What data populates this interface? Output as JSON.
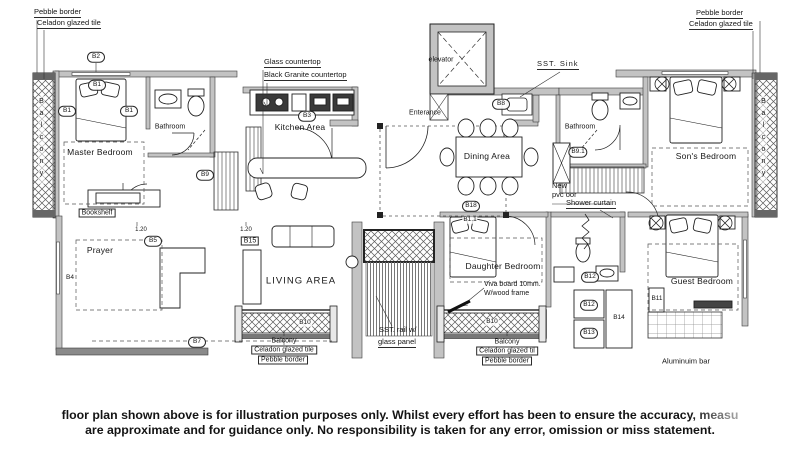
{
  "colors": {
    "ink": "#1b1b1b",
    "wall_fill": "#c3c3c3",
    "dark_wall": "#8a8a8a"
  },
  "rooms": {
    "master_bedroom": "Master Bedroom",
    "bathroom_left": "Bathroom",
    "kitchen": "Kitchen Area",
    "living": "LIVING AREA",
    "prayer": "Prayer",
    "dining": "Dining Area",
    "bathroom_right": "Bathroom",
    "sons_bedroom": "Son's Bedroom",
    "daughter_bedroom": "Daughter Bedroom",
    "guest_bedroom": "Guest Bedroom",
    "entrance": "Enterance",
    "elevator": "elevator",
    "balcony_left": "Balcony",
    "balcony_right": "Balcony"
  },
  "callouts": {
    "tl_pebble": "Pebble border",
    "tl_celadon": "Celadon glazed tile",
    "tr_pebble": "Pebble border",
    "tr_celadon": "Celadon glazed tile",
    "glass_top": "Glass countertop",
    "granite_top": "Black Granite countertop",
    "sst_sink": "SST.  Sink",
    "new_pvc_1": "New",
    "new_pvc_2": "pvc    oor",
    "shower_curtain": "Shower curtain",
    "viva_1": "Viva board 10mm.",
    "viva_2": "W/wood frame",
    "rail_1": "SST. rail w/",
    "rail_2": "glass panel",
    "bookshelf": "Bookshelf",
    "aluminium_bar": "Aluminuim bar",
    "bl_balcony": "Balcony",
    "bl_celadon": "Celadon glazed tile",
    "bl_pebble": "Pebble border",
    "br_balcony": "Balcony",
    "br_celadon": "Celadon glazed til",
    "br_pebble": "Pebble border"
  },
  "tags": {
    "b1_top": "B1",
    "b1_left": "B1",
    "b1_right": "B1",
    "b2": "B2",
    "b3": "B3",
    "b4": "B4",
    "b5": "B5",
    "b7": "B7",
    "b8": "B8",
    "b9": "B9",
    "b9_1": "B9.1",
    "b10_left": "B10",
    "b10_right": "B10",
    "b11": "B11",
    "b1_1": "B1.1",
    "b12_top": "B12",
    "b12_mid": "B12",
    "b13": "B13",
    "b14": "B14",
    "b15": "B15",
    "b18": "B18",
    "dim_1": "1.20",
    "dim_2": "1.20"
  },
  "disclaimer": {
    "line1": "floor plan shown above is for illustration purposes only. Whilst every effort has been to ensure the accuracy, measu",
    "line2": "are approximate and for guidance only. No responsibility is taken for any error, omission or miss statement."
  }
}
